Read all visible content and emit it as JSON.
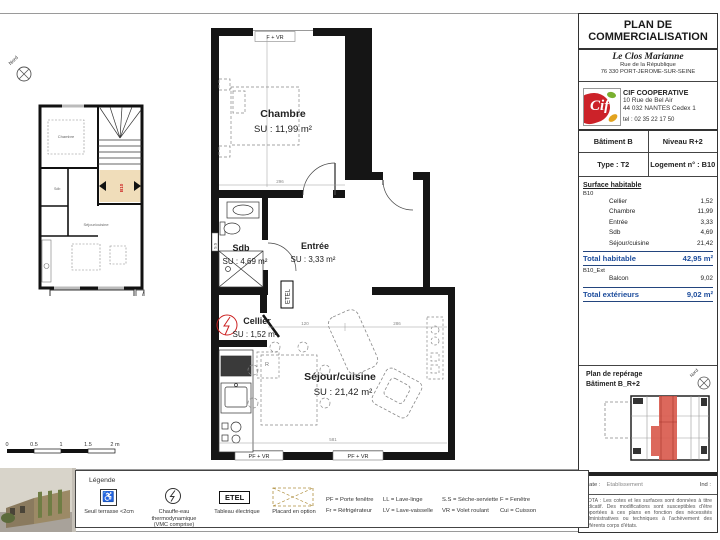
{
  "title_block": {
    "title_line1": "PLAN DE",
    "title_line2": "COMMERCIALISATION",
    "project": {
      "name": "Le Clos Marianne",
      "address1": "Rue de la République",
      "address2": "76 330 PORT-JEROME-SUR-SEINE"
    },
    "company": {
      "logo_text": "Cif",
      "name": "CIF COOPERATIVE",
      "address1": "10 Rue de Bel Air",
      "address2": "44 032 NANTES Cedex 1",
      "tel": "tel : 02 35 22 17 50"
    },
    "building": "Bâtiment B",
    "level": "Niveau R+2",
    "type": "Type : T2",
    "unit": "Logement n° : B10",
    "surface_table": {
      "heading": "Surface habitable",
      "group": "B10",
      "rows": [
        {
          "label": "Cellier",
          "value": "1,52"
        },
        {
          "label": "Chambre",
          "value": "11,99"
        },
        {
          "label": "Entrée",
          "value": "3,33"
        },
        {
          "label": "Sdb",
          "value": "4,69"
        },
        {
          "label": "Séjour/cuisine",
          "value": "21,42"
        }
      ],
      "total_label": "Total habitable",
      "total_value": "42,95 m²",
      "ext_group": "B10_Ext",
      "ext_rows": [
        {
          "label": "Balcon",
          "value": "9,02"
        }
      ],
      "ext_total_label": "Total extérieurs",
      "ext_total_value": "9,02 m²"
    },
    "key_plan": {
      "title": "Plan de repérage",
      "subtitle": "Bâtiment B_R+2",
      "north": "Nord"
    },
    "footer": {
      "date_label": "Date :",
      "etab_label": "Etablissement",
      "ind_label": "Ind :",
      "nota": "NOTA : Les cotes et les surfaces sont données à titre indicatif. Des modifications sont susceptibles d'être apportées à ces plans en fonction des nécessités administratives ou techniques à l'achèvement des différents corps d'états."
    }
  },
  "plan": {
    "north": "Nord",
    "rooms": {
      "chambre": {
        "name": "Chambre",
        "su": "SU : 11,99 m²"
      },
      "sdb": {
        "name": "Sdb",
        "su": "SU : 4,69 m²"
      },
      "entree": {
        "name": "Entrée",
        "su": "SU : 3,33 m²"
      },
      "cellier": {
        "name": "Cellier",
        "su": "SU : 1,52 m²"
      },
      "sejour": {
        "name": "Séjour/cuisine",
        "su": "SU : 21,42 m²"
      }
    },
    "windows": {
      "top": "F + VR",
      "bottom_left": "PF + VR",
      "bottom_right": "PF + VR"
    },
    "etel": "ETEL",
    "fridge": "R",
    "towel": "S.S",
    "dims": {
      "chambre_w": "296",
      "sejour_w": "581",
      "sejour_a": "120",
      "sejour_b": "286"
    },
    "scale": {
      "t0": "0",
      "t1": "0.5",
      "t2": "1",
      "t3": "1.5",
      "t4": "2 m"
    }
  },
  "mini_plan": {
    "north": "Nord",
    "unit": "B10",
    "chambre": "Chambre",
    "sdb": "Sdb",
    "sejour": "Séjour/cuisine",
    "balcon": "Balcon",
    "balcon_su": "SU : 9,02 m²"
  },
  "legend": {
    "title": "Légende",
    "items": [
      {
        "label1": "Seuil terrasse <2cm",
        "label2": "",
        "label3": ""
      },
      {
        "label1": "Chauffe-eau",
        "label2": "thermodynamique",
        "label3": "(VMC comprise)"
      },
      {
        "icon_text": "ETEL",
        "label1": "Tableau électrique",
        "label2": "",
        "label3": ""
      },
      {
        "label1": "Placard en option",
        "label2": "",
        "label3": ""
      }
    ],
    "abbr": [
      [
        "PF = Porte fenêtre",
        "Fr = Réfrigérateur"
      ],
      [
        "LL = Lave-linge",
        "LV = Lave-vaisselle"
      ],
      [
        "S.S = Sèche-serviette",
        "VR = Volet roulant"
      ],
      [
        "F = Fenêtre",
        "Cui = Cuisson"
      ]
    ]
  },
  "colors": {
    "accent_blue": "#1c4c9c",
    "highlight_tan": "#f0ddba",
    "unit_red": "#d8584a",
    "logo_red": "#cc2229"
  }
}
